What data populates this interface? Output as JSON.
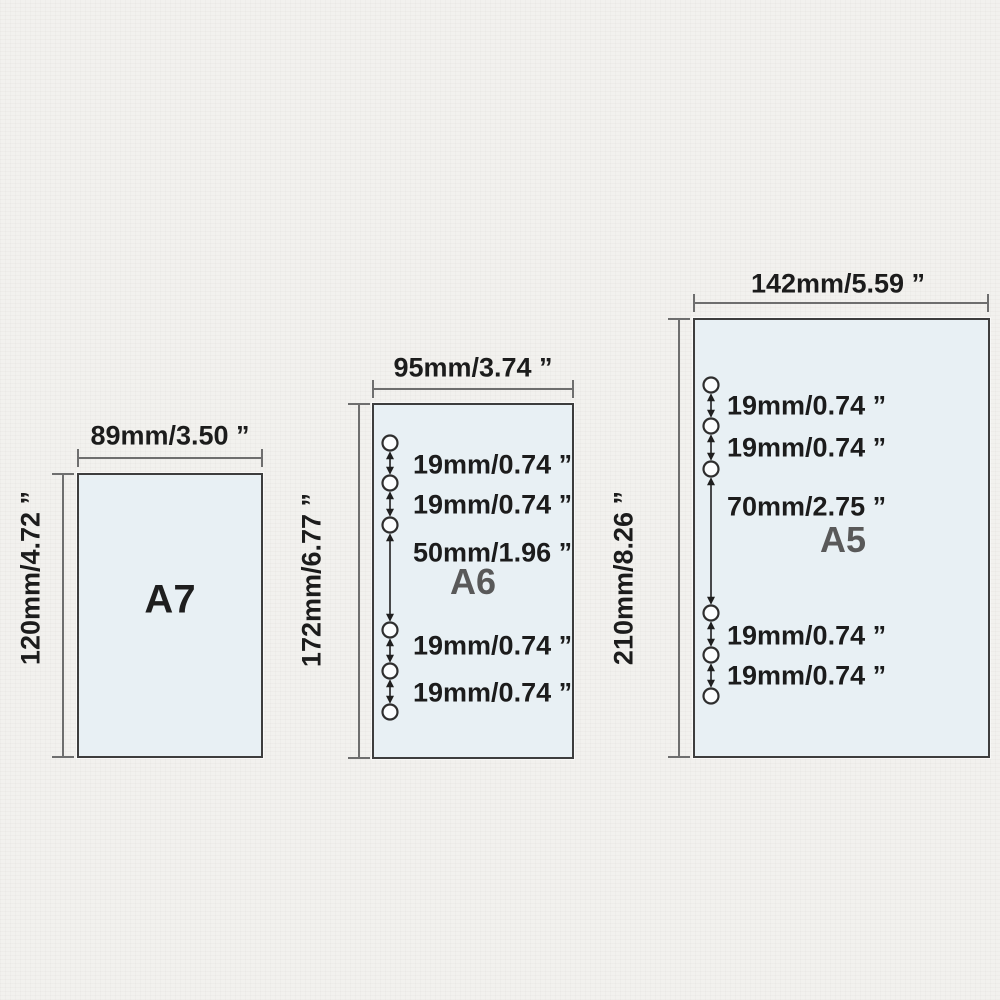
{
  "colors": {
    "background": "#f2f1ee",
    "paper_fill": "#e8f0f4",
    "paper_border": "#3d3d3d",
    "dimension_line": "#6e6e6e",
    "label_text": "#1c1c1c",
    "size_name_small": "#1e1e1e",
    "size_name_large": "#595959"
  },
  "papers": [
    {
      "name": "A7",
      "width_label": "89mm/3.50 ”",
      "height_label": "120mm/4.72 ”",
      "hole_count": 0,
      "spacings": []
    },
    {
      "name": "A6",
      "width_label": "95mm/3.74 ”",
      "height_label": "172mm/6.77 ”",
      "hole_count": 6,
      "spacings": [
        "19mm/0.74 ”",
        "19mm/0.74 ”",
        "50mm/1.96 ”",
        "19mm/0.74 ”",
        "19mm/0.74 ”"
      ]
    },
    {
      "name": "A5",
      "width_label": "142mm/5.59 ”",
      "height_label": "210mm/8.26 ”",
      "hole_count": 6,
      "spacings": [
        "19mm/0.74 ”",
        "19mm/0.74 ”",
        "70mm/2.75 ”",
        "19mm/0.74 ”",
        "19mm/0.74 ”"
      ]
    }
  ]
}
